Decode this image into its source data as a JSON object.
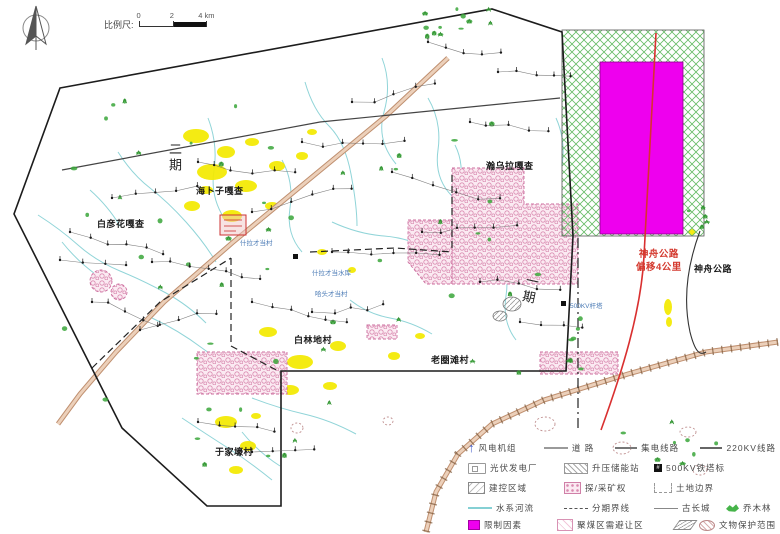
{
  "colors": {
    "magenta": "#ee00ee",
    "yellow": "#f4ea00",
    "river_cyan": "#85d0d4",
    "road_red": "#d93030",
    "hatch_green": "#66bb66",
    "mining_pink": "#d98ab0",
    "tree_green": "#3aa63a"
  },
  "scale_bar": {
    "label": "比例尺:",
    "ticks": [
      "0",
      "2",
      "4 km"
    ]
  },
  "map_labels": {
    "phase2": "二期",
    "phase1": "一期",
    "haibuzi": "海卜子嘎查",
    "baiyanhua": "白彦花嘎查",
    "hanwula": "瀚乌拉嘎查",
    "bailindi": "白林地村",
    "laoquantan": "老圈滩村",
    "yujiahao": "于家壕村",
    "shila_village": "什拉才当村",
    "shila_reservoir": "什拉才当水库",
    "hatou_village": "哈头才当村",
    "tower": "500KV杆塔",
    "shenzhou_offset_1": "神舟公路",
    "shenzhou_offset_2": "偏移4公里",
    "shenzhou_road": "神舟公路"
  },
  "legend": {
    "rows": [
      {
        "items": [
          {
            "icon": "wind-turbine-icon",
            "label": "风电机组"
          },
          {
            "icon": "road-line-icon",
            "label": "道  路"
          },
          {
            "icon": "collector-line-icon",
            "label": "集电线路"
          },
          {
            "icon": "hv-line-icon",
            "label": "220KV线路"
          }
        ]
      },
      {
        "items": [
          {
            "icon": "pv-plant-icon",
            "label": "光伏发电厂"
          },
          {
            "icon": "booster-station-icon",
            "label": "升压储能站"
          },
          {
            "icon": "tower-mark-icon",
            "label": "500KV铁塔标"
          }
        ]
      },
      {
        "items": [
          {
            "icon": "control-area-icon",
            "label": "建控区域"
          },
          {
            "icon": "mining-right-icon",
            "label": "探/采矿权"
          },
          {
            "icon": "land-boundary-icon",
            "label": "土地边界"
          }
        ]
      },
      {
        "items": [
          {
            "icon": "river-icon",
            "label": "水系河流"
          },
          {
            "icon": "phase-line-icon",
            "label": "分期界线"
          },
          {
            "icon": "great-wall-icon",
            "label": "古长城"
          },
          {
            "icon": "arbor-forest-icon",
            "label": "乔木林"
          }
        ]
      },
      {
        "items": [
          {
            "icon": "restrict-factor-icon",
            "label": "限制因素"
          },
          {
            "icon": "coal-avoid-icon",
            "label": "聚煤区需避让区"
          },
          {
            "icon": "heritage-area-icon",
            "label": "文物保护范围"
          }
        ]
      }
    ]
  }
}
